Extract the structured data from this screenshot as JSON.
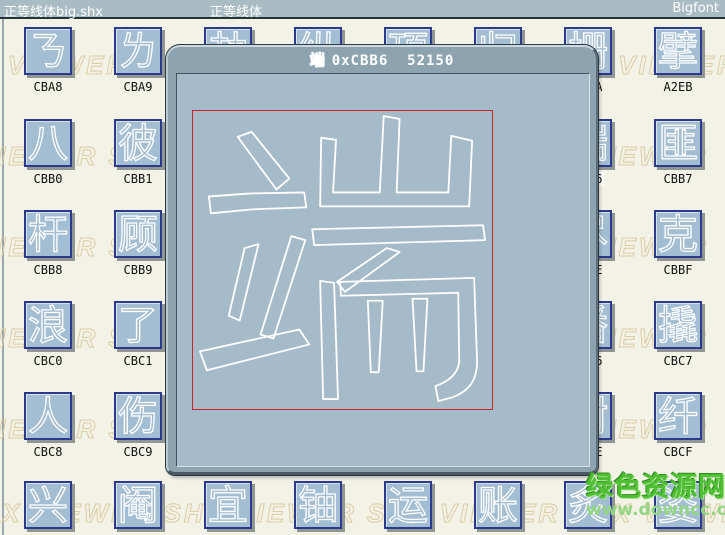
{
  "titlebar": {
    "left": "正等线体big.shx",
    "center": "正等线体",
    "right": "Bigfont"
  },
  "dialog": {
    "glyph_char": "端",
    "code_hex": "0xCBB6",
    "code_dec": "52150",
    "glyph_paths": [
      "M45,26 L59,21 L97,68 L84,79 Z",
      "M16,86 L58,83 L112,82 L114,97 L60,99 L18,103 Z",
      "M52,138 L66,134 L47,211 L36,206 Z",
      "M99,126 L113,130 L81,229 L68,225 Z",
      "M7,242 L107,220 L117,235 L14,261 Z",
      "M129,27 L144,29 L141,82 L188,82 L192,5 L208,8 L205,82 L257,82 L260,25 L281,30 L278,96 L128,96 Z",
      "M120,119 L292,115 L294,130 L122,135 Z",
      "M195,138 L208,142 L153,182 L145,172 Z",
      "M128,171 L142,173 L146,290 L131,290 Z",
      "M148,172 L283,168 L286,252 C286,270 279,281 262,288 L247,292 L244,277 C258,272 267,264 268,252 L267,183 L149,186 Z",
      "M176,191 L191,191 L187,263 L179,263 Z",
      "M221,189 L236,189 L232,262 L225,262 Z"
    ]
  },
  "watermark": {
    "text": "SHX VIEWER      SHX VIEWER      SHX VIEWER      SHX VIEWER",
    "rows": [
      {
        "y": 50,
        "x": -65
      },
      {
        "y": 141,
        "x": -95
      },
      {
        "y": 232,
        "x": -95
      },
      {
        "y": 323,
        "x": -95
      },
      {
        "y": 414,
        "x": -95
      },
      {
        "y": 498,
        "x": -40
      }
    ]
  },
  "site_watermark": {
    "name": "绿色资源网",
    "url": "www.downcc.com"
  },
  "grid": {
    "tile_size": 48,
    "cols_x": [
      24,
      114,
      204,
      294,
      384,
      474,
      564,
      654
    ],
    "rows_y": [
      27,
      119,
      210,
      301,
      392,
      481
    ],
    "rows": [
      [
        {
          "char": "ㄋ",
          "code": "CBA8"
        },
        {
          "char": "ㄌ",
          "code": "CBA9"
        },
        {
          "char": "劫",
          "code": ""
        },
        {
          "char": "纵",
          "code": ""
        },
        {
          "char": "顶",
          "code": ""
        },
        {
          "char": "归",
          "code": ""
        },
        {
          "char": "栅",
          "code": "A2EA"
        },
        {
          "char": "擘",
          "code": "A2EB"
        }
      ],
      [
        {
          "char": "八",
          "code": "CBB0"
        },
        {
          "char": "彼",
          "code": "CBB1"
        },
        {
          "char": "",
          "code": ""
        },
        {
          "char": "",
          "code": ""
        },
        {
          "char": "",
          "code": ""
        },
        {
          "char": "",
          "code": ""
        },
        {
          "char": "端",
          "code": "CBB6",
          "selected": true
        },
        {
          "char": "匪",
          "code": "CBB7"
        }
      ],
      [
        {
          "char": "杆",
          "code": "CBB8"
        },
        {
          "char": "顾",
          "code": "CBB9"
        },
        {
          "char": "",
          "code": ""
        },
        {
          "char": "",
          "code": ""
        },
        {
          "char": "",
          "code": ""
        },
        {
          "char": "",
          "code": ""
        },
        {
          "char": "尽",
          "code": "CBBE"
        },
        {
          "char": "克",
          "code": "CBBF"
        }
      ],
      [
        {
          "char": "浪",
          "code": "CBC0"
        },
        {
          "char": "了",
          "code": "CBC1"
        },
        {
          "char": "",
          "code": ""
        },
        {
          "char": "",
          "code": ""
        },
        {
          "char": "",
          "code": ""
        },
        {
          "char": "",
          "code": ""
        },
        {
          "char": "潘",
          "code": "CBC6"
        },
        {
          "char": "撬",
          "code": "CBC7"
        }
      ],
      [
        {
          "char": "人",
          "code": "CBC8"
        },
        {
          "char": "伤",
          "code": "CBC9"
        },
        {
          "char": "",
          "code": ""
        },
        {
          "char": "",
          "code": ""
        },
        {
          "char": "",
          "code": ""
        },
        {
          "char": "",
          "code": ""
        },
        {
          "char": "尉",
          "code": "CBCE"
        },
        {
          "char": "纤",
          "code": "CBCF"
        }
      ],
      [
        {
          "char": "兴",
          "code": ""
        },
        {
          "char": "阉",
          "code": ""
        },
        {
          "char": "宜",
          "code": ""
        },
        {
          "char": "铀",
          "code": ""
        },
        {
          "char": "运",
          "code": ""
        },
        {
          "char": "账",
          "code": ""
        },
        {
          "char": "炙",
          "code": ""
        },
        {
          "char": "姿",
          "code": ""
        }
      ]
    ]
  },
  "colors": {
    "page_bg": "#f3f2e6",
    "topbar_bg": "#a9bcc3",
    "tile_bg": "#a3bdd2",
    "tile_border": "#2c3a8e",
    "dialog_frame": "#8da4b0",
    "dialog_content_bg": "#a6bbc9",
    "glyph_outline": "#ffffff",
    "selection_box": "#cc2424",
    "watermark_tan": "#dccda5",
    "watermark_green": "#4fbe33"
  }
}
